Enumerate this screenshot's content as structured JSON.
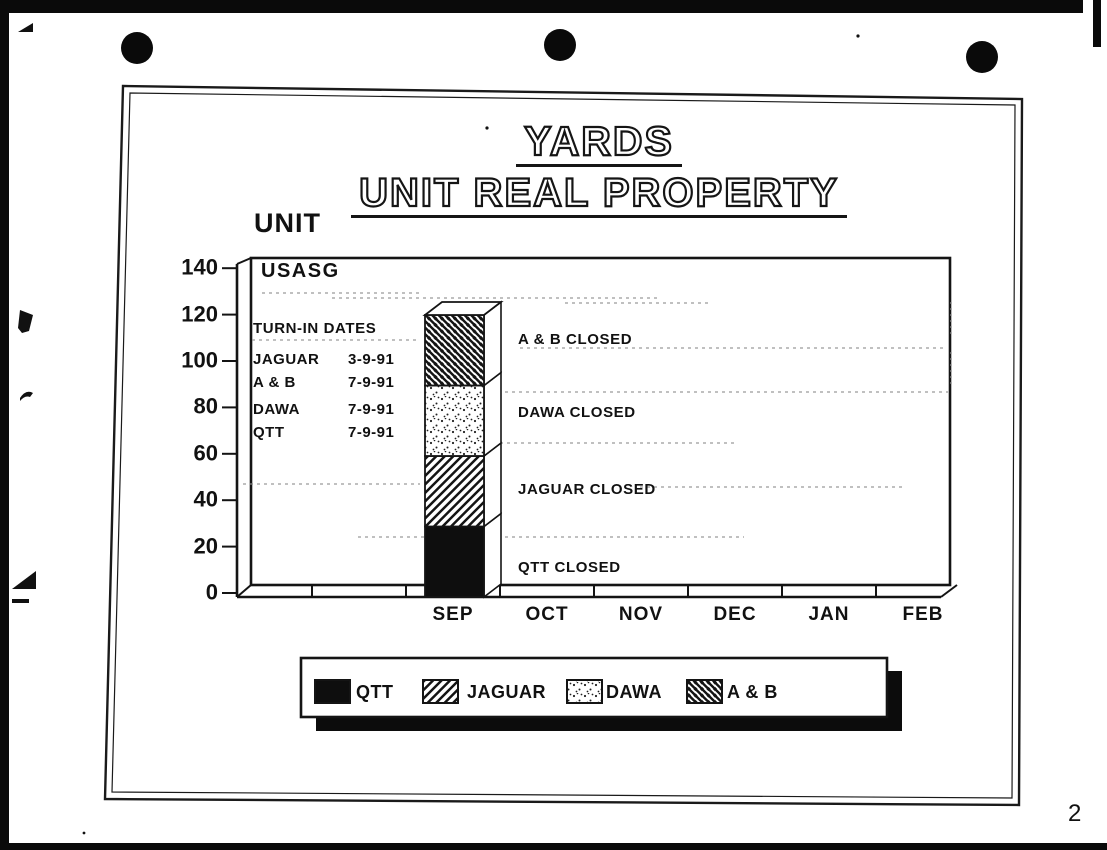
{
  "page": {
    "page_number": "2",
    "slide_title_line1": "YARDS",
    "slide_title_line2": "UNIT REAL PROPERTY"
  },
  "chart_data": {
    "type": "bar",
    "stacked": true,
    "title": "YARDS — UNIT REAL PROPERTY",
    "ylabel": "UNIT",
    "xlabel": "",
    "ylim": [
      0,
      140
    ],
    "yticks": [
      0,
      20,
      40,
      60,
      80,
      100,
      120,
      140
    ],
    "categories": [
      "SEP",
      "OCT",
      "NOV",
      "DEC",
      "JAN",
      "FEB"
    ],
    "series": [
      {
        "name": "QTT",
        "pattern": "solid-black",
        "values": [
          30,
          0,
          0,
          0,
          0,
          0
        ]
      },
      {
        "name": "JAGUAR",
        "pattern": "diagonal-forward-hatch",
        "values": [
          30,
          0,
          0,
          0,
          0,
          0
        ]
      },
      {
        "name": "DAWA",
        "pattern": "dotted",
        "values": [
          30,
          0,
          0,
          0,
          0,
          0
        ]
      },
      {
        "name": "A & B",
        "pattern": "diagonal-back-hatch",
        "values": [
          30,
          0,
          0,
          0,
          0,
          0
        ]
      }
    ],
    "bar_total_sep": 120,
    "grid": "faint-dashed-fragments",
    "legend_position": "bottom",
    "style": "3d-stacked-bar"
  },
  "annotations": {
    "plot_label": "USASG",
    "turn_in": {
      "heading": "TURN-IN DATES",
      "rows": [
        {
          "name": "JAGUAR",
          "date": "3-9-91"
        },
        {
          "name": "A & B",
          "date": "7-9-91"
        },
        {
          "name": "DAWA",
          "date": "7-9-91"
        },
        {
          "name": "QTT",
          "date": "7-9-91"
        }
      ]
    },
    "closed_labels": [
      "A & B CLOSED",
      "DAWA CLOSED",
      "JAGUAR CLOSED",
      "QTT CLOSED"
    ]
  },
  "legend": {
    "items": [
      {
        "label": "QTT",
        "pattern": "solid-black"
      },
      {
        "label": "JAGUAR",
        "pattern": "diagonal-forward-hatch"
      },
      {
        "label": "DAWA",
        "pattern": "dotted"
      },
      {
        "label": "A & B",
        "pattern": "diagonal-back-hatch"
      }
    ]
  },
  "colors": {
    "ink": "#111111",
    "paper": "#ffffff"
  }
}
